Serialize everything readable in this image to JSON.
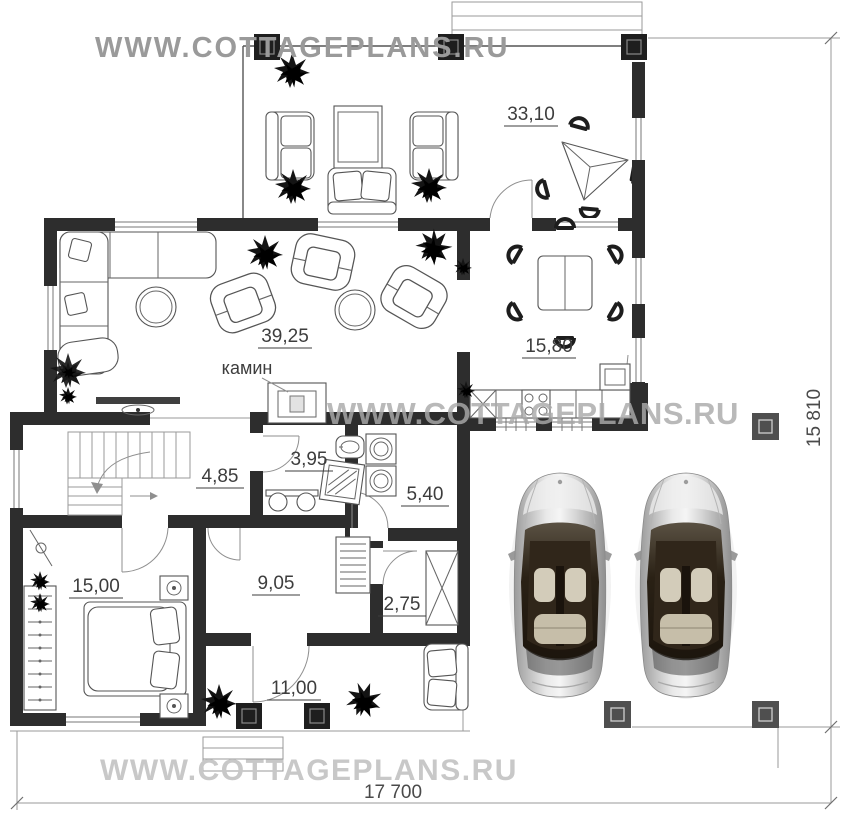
{
  "watermarks": {
    "top": "WWW.COTTAGEPLANS.RU",
    "middle": "WWW.COTTAGEPLANS.RU",
    "bottom": "WWW.COTTAGEPLANS.RU"
  },
  "dimensions": {
    "overall_width": "17 700",
    "overall_height": "15 810"
  },
  "rooms": {
    "terrace_top": "33,10",
    "living": "39,25",
    "kitchen_dining": "15,80",
    "hall": "4,85",
    "bathroom": "3,95",
    "laundry": "5,40",
    "bedroom": "15,00",
    "corridor": "9,05",
    "closet": "2,75",
    "terrace_bottom": "11,00"
  },
  "annotations": {
    "fireplace": "камин"
  },
  "colors": {
    "wall": "#2d2d2d",
    "thin_line": "#9a9a9a",
    "label": "#3d3d3d",
    "watermark_top": "#9a9a9a",
    "watermark_middle": "#b0b0b0",
    "watermark_bottom": "#c8c8c8",
    "carport_column": "#4f4f4f"
  }
}
